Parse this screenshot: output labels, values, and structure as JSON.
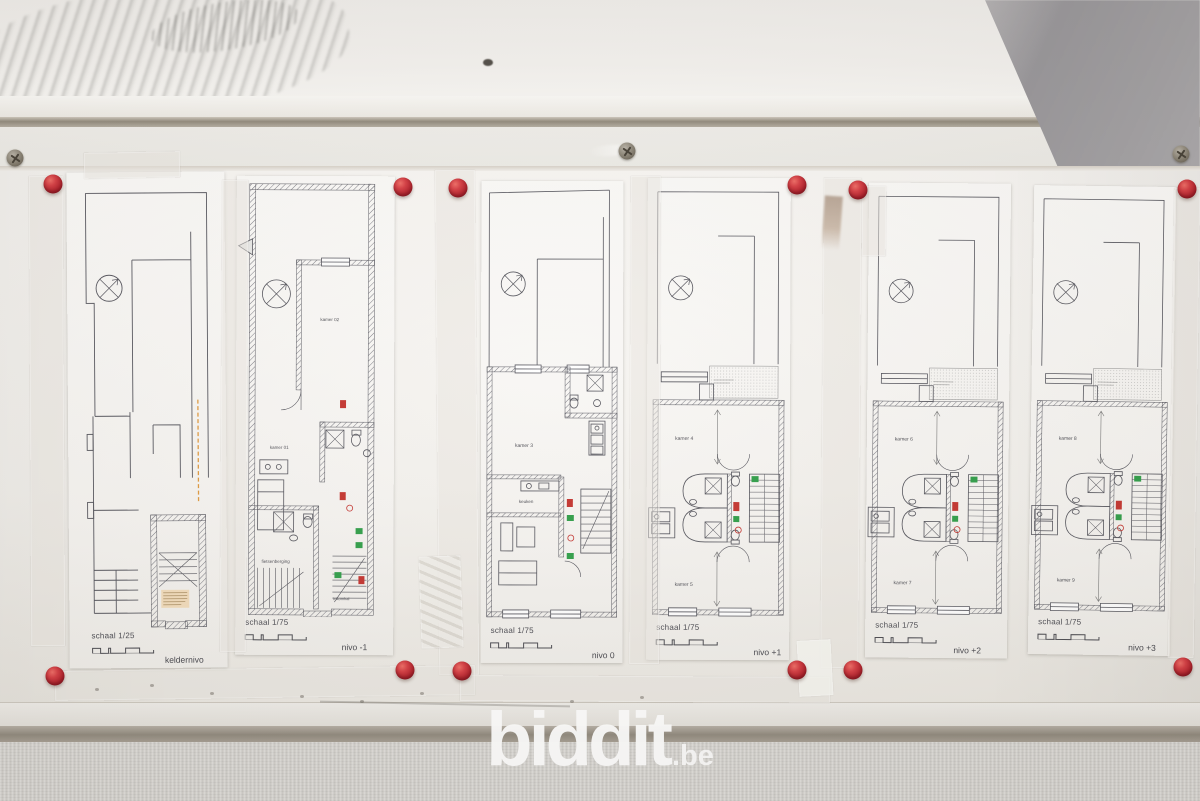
{
  "watermark": {
    "brand": "biddit",
    "tld": ".be"
  },
  "sheets": [
    {
      "level_label": "keldernivo",
      "scale_label": "schaal 1/25",
      "rooms": []
    },
    {
      "level_label": "nivo -1",
      "scale_label": "schaal 1/75",
      "rooms": [
        {
          "label": "kamer 02"
        },
        {
          "label": "kamer 01"
        },
        {
          "label": "fietsenberging"
        },
        {
          "label": "inkomhal"
        }
      ]
    },
    {
      "level_label": "nivo 0",
      "scale_label": "schaal 1/75",
      "rooms": [
        {
          "label": "kamer 3"
        },
        {
          "label": "keuken"
        }
      ]
    },
    {
      "level_label": "nivo +1",
      "scale_label": "schaal 1/75",
      "rooms": [
        {
          "label": "kamer 4"
        },
        {
          "label": "kamer 5"
        }
      ]
    },
    {
      "level_label": "nivo +2",
      "scale_label": "schaal 1/75",
      "rooms": [
        {
          "label": "kamer 6"
        },
        {
          "label": "kamer 7"
        }
      ]
    },
    {
      "level_label": "nivo +3",
      "scale_label": "schaal 1/75",
      "rooms": [
        {
          "label": "kamer 8"
        },
        {
          "label": "kamer 9"
        }
      ]
    }
  ],
  "colors": {
    "pin_red": "#b5202b",
    "exit_sign_green": "#2f9e48",
    "extinguisher_red": "#c4332e",
    "highlight_orange": "#e0993f",
    "watermark_white": "#ffffff"
  }
}
